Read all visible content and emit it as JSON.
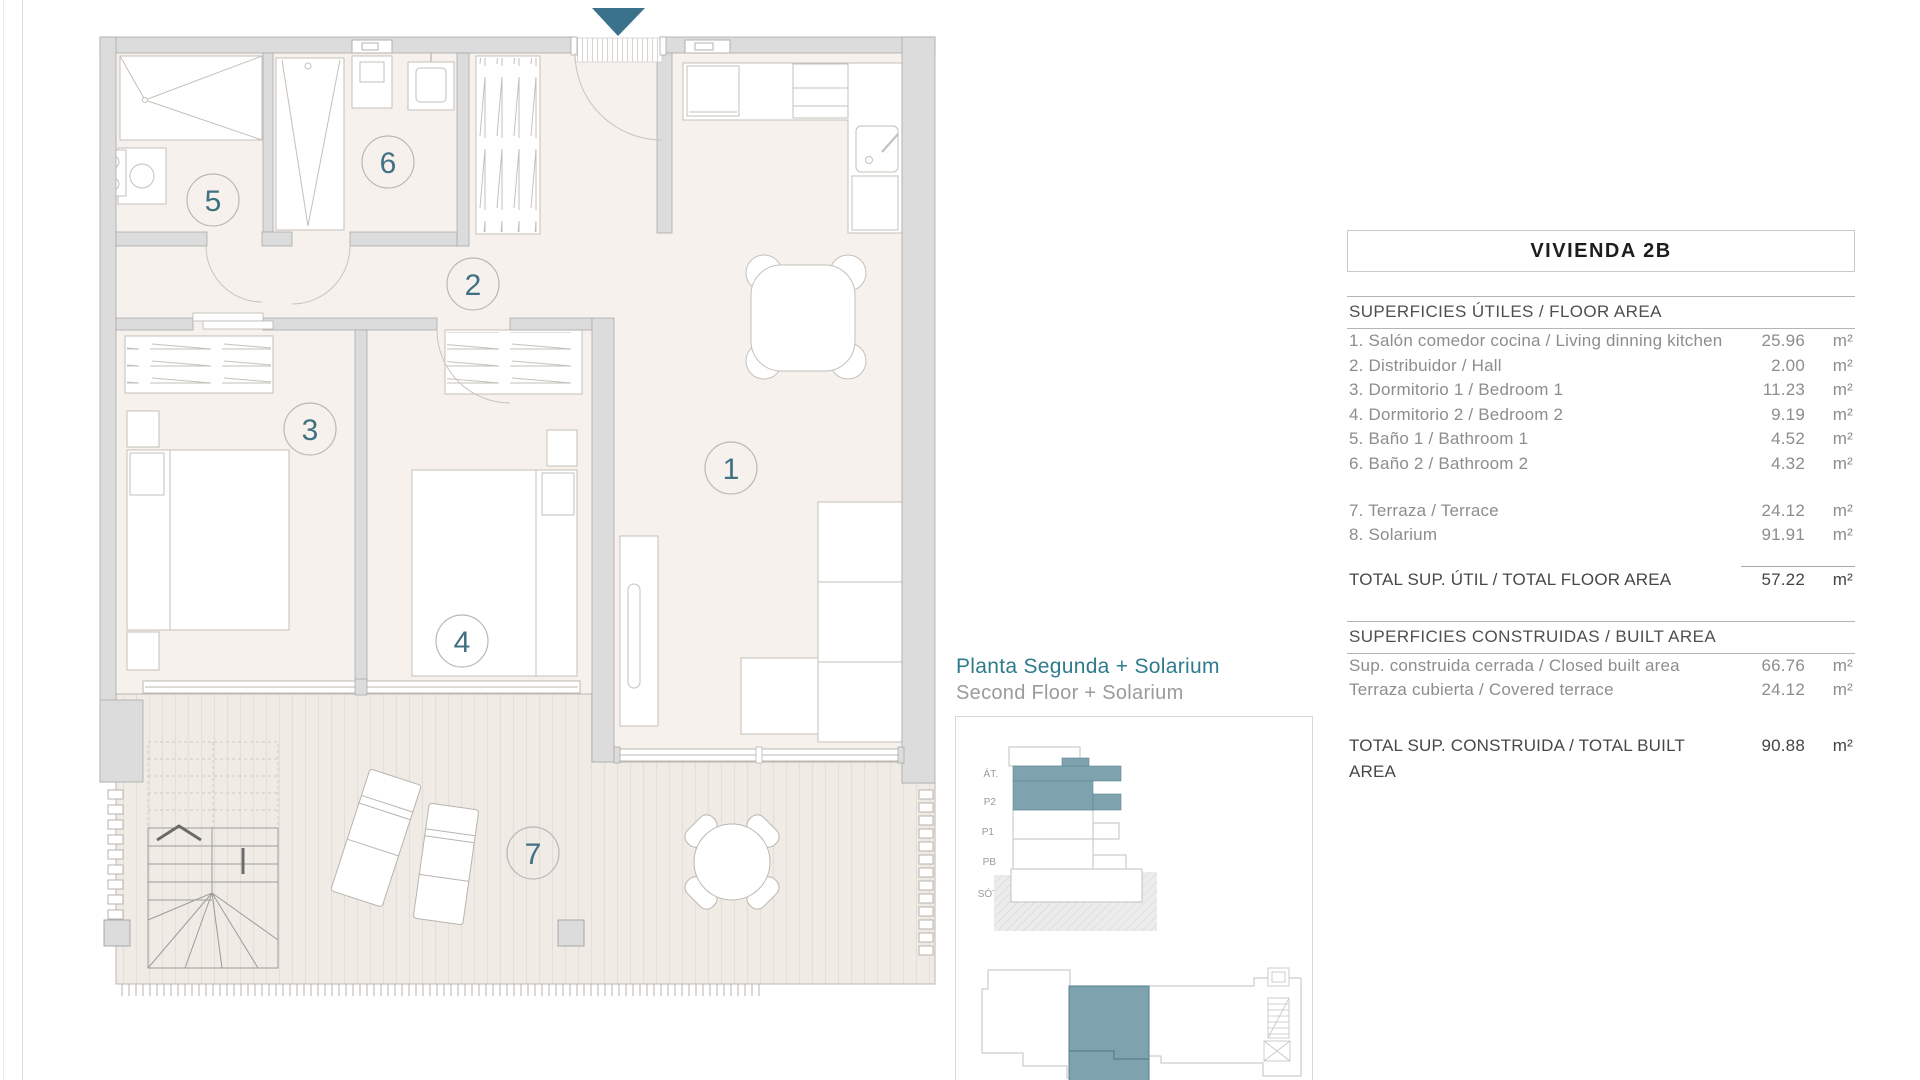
{
  "header": {
    "title": "VIVIENDA 2B"
  },
  "caption": {
    "title_es": "Planta Segunda + Solarium",
    "title_en": "Second Floor + Solarium"
  },
  "plan": {
    "rooms": [
      {
        "number": "1"
      },
      {
        "number": "2"
      },
      {
        "number": "3"
      },
      {
        "number": "4"
      },
      {
        "number": "5"
      },
      {
        "number": "6"
      },
      {
        "number": "7"
      }
    ]
  },
  "elevation": {
    "labels": [
      "ÁT.",
      "P2",
      "P1",
      "PB",
      "SÓT."
    ]
  },
  "floor_area": {
    "title": "SUPERFICIES ÚTILES / FLOOR AREA",
    "rows": [
      {
        "label": "1. Salón comedor cocina / Living dinning kitchen",
        "value": "25.96",
        "unit": "m²"
      },
      {
        "label": "2. Distribuidor / Hall",
        "value": "2.00",
        "unit": "m²"
      },
      {
        "label": "3. Dormitorio 1 / Bedroom 1",
        "value": "11.23",
        "unit": "m²"
      },
      {
        "label": "4. Dormitorio 2 / Bedroom 2",
        "value": "9.19",
        "unit": "m²"
      },
      {
        "label": "5. Baño 1 / Bathroom 1",
        "value": "4.52",
        "unit": "m²"
      },
      {
        "label": "6. Baño 2 / Bathroom 2",
        "value": "4.32",
        "unit": "m²"
      }
    ],
    "outdoor_rows": [
      {
        "label": "7. Terraza / Terrace",
        "value": "24.12",
        "unit": "m²"
      },
      {
        "label": "8. Solarium",
        "value": "91.91",
        "unit": "m²"
      }
    ],
    "total": {
      "label": "TOTAL SUP. ÚTIL / TOTAL FLOOR AREA",
      "value": "57.22",
      "unit": "m²"
    }
  },
  "built_area": {
    "title": "SUPERFICIES CONSTRUIDAS / BUILT AREA",
    "rows": [
      {
        "label": "Sup. construida cerrada / Closed built area",
        "value": "66.76",
        "unit": "m²"
      },
      {
        "label": "Terraza cubierta / Covered terrace",
        "value": "24.12",
        "unit": "m²"
      }
    ],
    "total": {
      "label": "TOTAL SUP. CONSTRUIDA /  TOTAL BUILT AREA",
      "value": "90.88",
      "unit": "m²"
    }
  },
  "colors": {
    "accent_teal": "#39728a",
    "highlight_teal": "#7fa3ae",
    "room_number_teal": "#3f7183",
    "wall_gray": "#dcdcdc",
    "floor_beige": "#f6f1ec"
  }
}
